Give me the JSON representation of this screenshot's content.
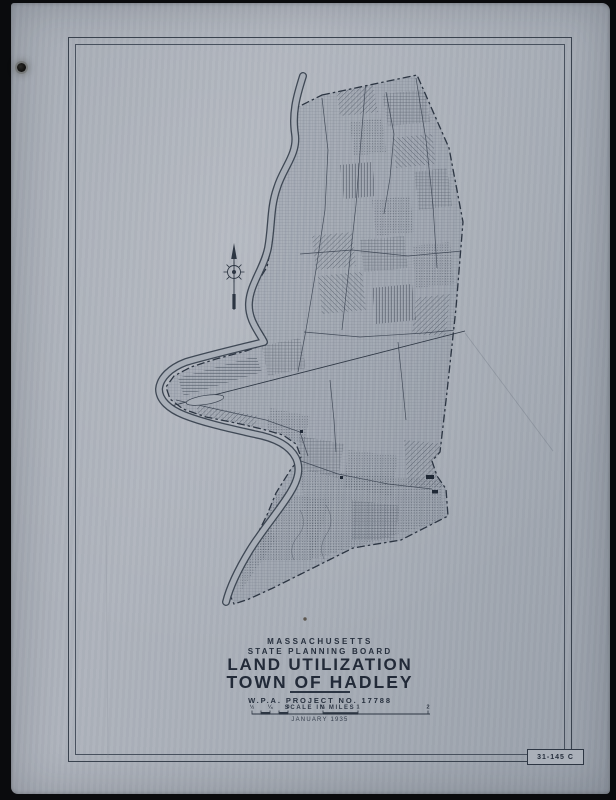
{
  "photo": {
    "background_color": "#0a0b0d"
  },
  "paper": {
    "color": "#a8aeb7",
    "ink_color": "#323b49"
  },
  "title_block": {
    "state": "MASSACHUSETTS",
    "agency": "STATE PLANNING BOARD",
    "title": "LAND UTILIZATION",
    "subtitle": "TOWN OF HADLEY",
    "project": "W.P.A. PROJECT NO. 17788",
    "scale_caption": "SCALE IN MILES",
    "date": "JANUARY 1935"
  },
  "scale_bar": {
    "labels": [
      "½",
      "¼",
      "0",
      "½",
      "1",
      "2"
    ]
  },
  "sheet_number": "31-145 C",
  "icons": {
    "north_arrow": "north-arrow-with-compass-rose"
  }
}
